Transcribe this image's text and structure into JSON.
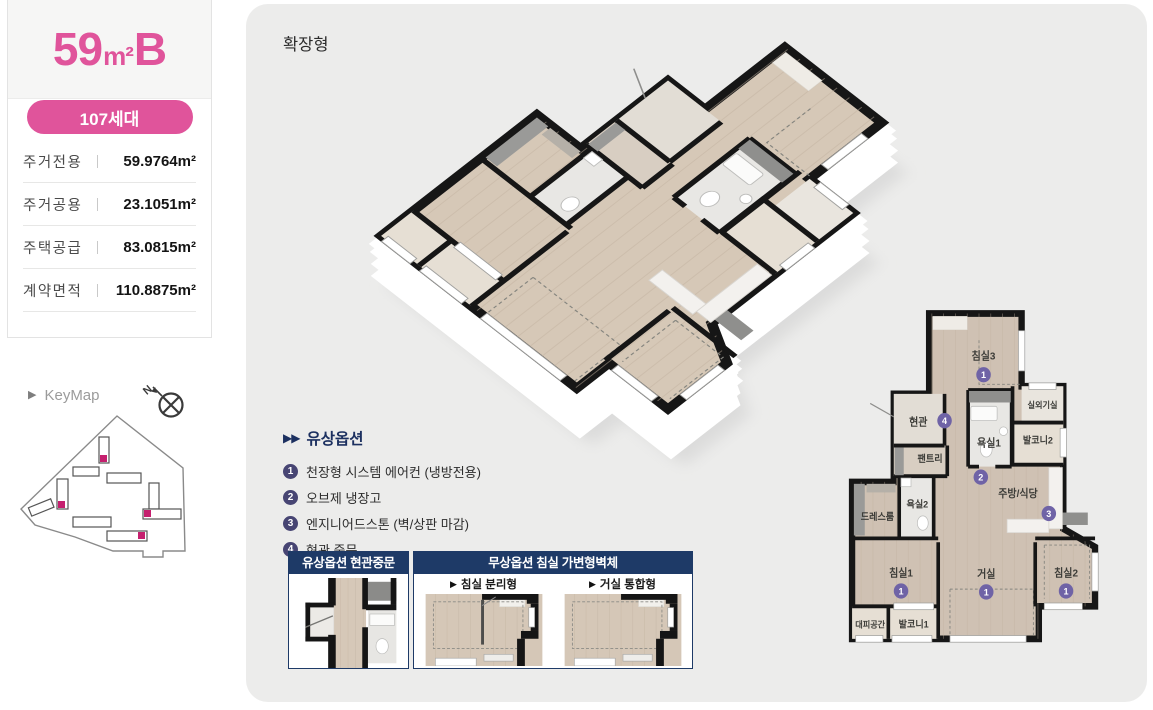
{
  "unit_card": {
    "title": {
      "size": "59",
      "unit": "m²",
      "type": "B"
    },
    "badge": "107세대",
    "specs": [
      {
        "label": "주거전용",
        "value": "59.9764",
        "unit": "m²"
      },
      {
        "label": "주거공용",
        "value": "23.1051",
        "unit": "m²"
      },
      {
        "label": "주택공급",
        "value": "83.0815",
        "unit": "m²"
      },
      {
        "label": "계약면적",
        "value": "110.8875",
        "unit": "m²"
      }
    ]
  },
  "keymap": {
    "label": "KeyMap",
    "north": "N"
  },
  "board": {
    "type_label": "확장형",
    "paid_options": {
      "title": "유상옵션",
      "items": [
        {
          "no": "1",
          "text": "천장형 시스템 에어컨 (냉방전용)"
        },
        {
          "no": "2",
          "text": "오브제 냉장고"
        },
        {
          "no": "3",
          "text": "엔지니어드스톤 (벽/상판 마감)"
        },
        {
          "no": "4",
          "text": "현관 중문"
        }
      ]
    },
    "door_panel": {
      "title": "유상옵션 현관중문"
    },
    "wall_panel": {
      "title": "무상옵션 침실 가변형벽체",
      "left_label": "침실 분리형",
      "right_label": "거실 통합형"
    },
    "plan": {
      "rooms": [
        {
          "label": "침실3"
        },
        {
          "label": "현관"
        },
        {
          "label": "실외기실"
        },
        {
          "label": "욕실1"
        },
        {
          "label": "발코니2"
        },
        {
          "label": "팬트리"
        },
        {
          "label": "욕실2"
        },
        {
          "label": "드레스룸"
        },
        {
          "label": "주방/식당"
        },
        {
          "label": "침실1"
        },
        {
          "label": "거실"
        },
        {
          "label": "침실2"
        },
        {
          "label": "대피공간"
        },
        {
          "label": "발코니1"
        }
      ],
      "markers": [
        {
          "no": "1"
        },
        {
          "no": "4"
        },
        {
          "no": "2"
        },
        {
          "no": "3"
        },
        {
          "no": "1"
        },
        {
          "no": "1"
        },
        {
          "no": "1"
        }
      ]
    }
  },
  "colors": {
    "accent_pink": "#e0549b",
    "header_navy": "#1e3a67",
    "option_badge_purple": "#474573",
    "plan_marker_purple": "#6f63a6",
    "wall_black": "#161616",
    "floor_beige": "#cfc1b3",
    "board_gray": "#ececeb"
  }
}
